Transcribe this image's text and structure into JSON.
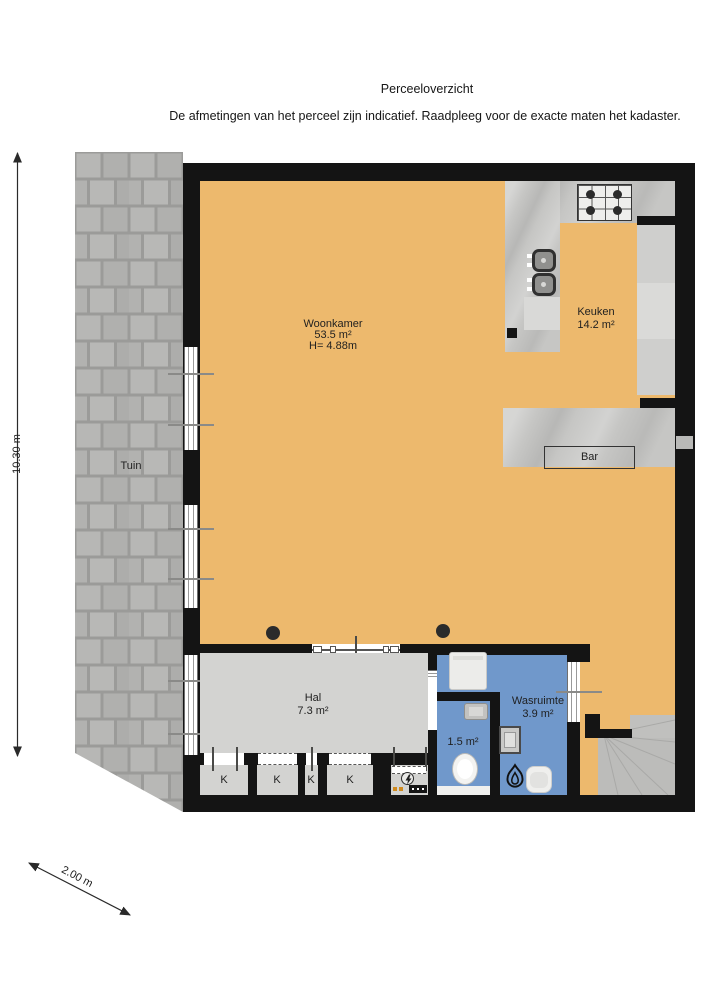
{
  "header": {
    "title": "Perceeloverzicht",
    "subtitle": "De afmetingen van het perceel zijn indicatief. Raadpleeg voor de exacte maten het kadaster."
  },
  "rooms": {
    "woonkamer": {
      "name": "Woonkamer",
      "area": "53.5 m²",
      "height": "H= 4.88m"
    },
    "keuken": {
      "name": "Keuken",
      "area": "14.2 m²"
    },
    "bar": {
      "name": "Bar"
    },
    "tuin": {
      "name": "Tuin"
    },
    "hal": {
      "name": "Hal",
      "area": "7.3 m²"
    },
    "wasruimte": {
      "name": "Wasruimte",
      "area": "3.9 m²"
    },
    "toilet": {
      "area": "1.5 m²"
    },
    "closets": [
      "K",
      "K",
      "K",
      "K"
    ]
  },
  "dimensions": {
    "height_label": "10.30 m",
    "width_label": "2.00 m"
  },
  "colors": {
    "floor": "#edb96d",
    "wet_room": "#7098cb",
    "hall_floor": "#d3d3d1",
    "wall": "#141414",
    "counter": "#c6c6c4",
    "garden_tile": "#b3b3b1",
    "stairs": "#bcbcba"
  }
}
